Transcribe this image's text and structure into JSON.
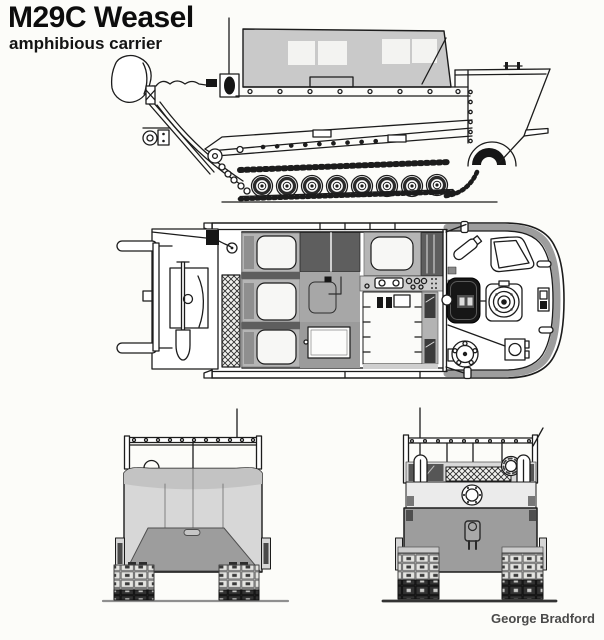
{
  "window": {
    "width": 604,
    "height": 640,
    "background": "#fcfcf9"
  },
  "header": {
    "title": "M29C Weasel",
    "subtitle": "amphibious carrier"
  },
  "credit": "George Bradford",
  "diagram": {
    "subject": "M29C Weasel amphibious carrier",
    "style": "multi-view technical line drawing",
    "views": [
      "side-profile",
      "overhead-plan",
      "front",
      "rear"
    ],
    "colors": {
      "line": "#1c1c1c",
      "canvas_top": "#c9c9c9",
      "panel_dark": "#5e5e5e",
      "floor_mid": "#a7a7a7",
      "hull_light": "#d7d7d7",
      "hull_mid": "#9d9d9d",
      "seat_frame": "#b5b5b5",
      "transom_light": "#ebebeb",
      "fitting_black": "#161616",
      "title_color": "#0d0d0d",
      "credit_color": "#4a4a4a",
      "background": "#fcfcf9"
    }
  }
}
